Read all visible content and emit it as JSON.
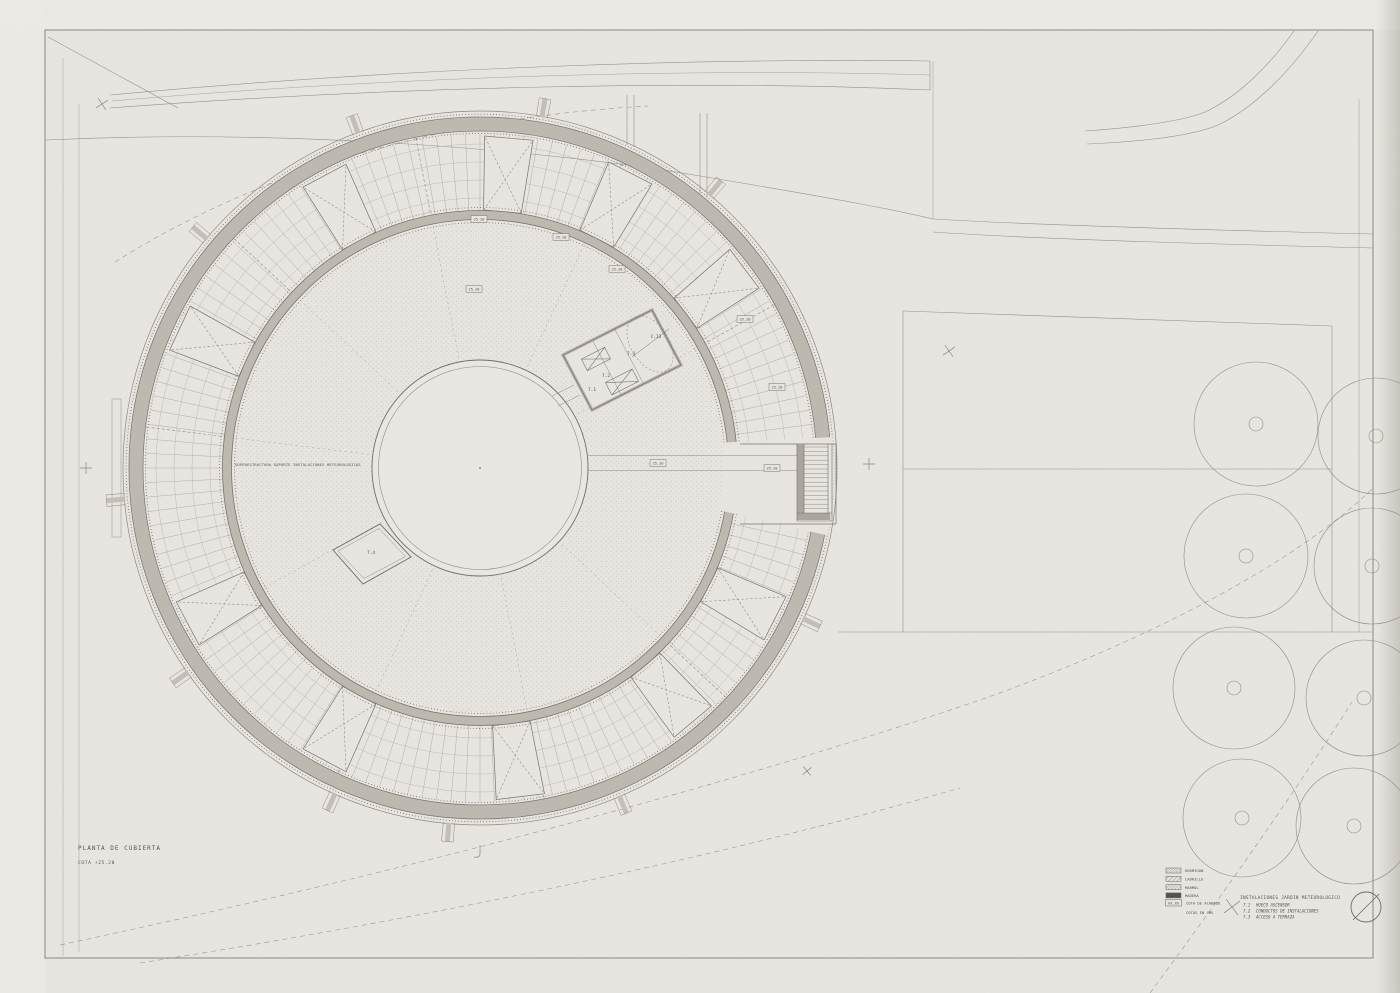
{
  "sheet": {
    "title": "PLANTA DE CUBIERTA",
    "subtitle": "COTA +25.20",
    "center_note": "SUPERESTRUCTURA SOPORTE INSTALACIONES METEOROLOGICAS"
  },
  "legend": {
    "materials": [
      {
        "name": "HORMIGON"
      },
      {
        "name": "LADRILLO"
      },
      {
        "name": "MARMOL"
      },
      {
        "name": "MADERA"
      }
    ],
    "cota_box": "XX.XX",
    "cota_label": "COTA DE ACABADO",
    "units_note": "COTAS EN CMS"
  },
  "keynotes": {
    "title": "INSTALACIONES JARDIN METEOROLOGICO",
    "items": [
      {
        "code": "7.1",
        "label": "HUECO ASCENSOR"
      },
      {
        "code": "7.2",
        "label": "CONDUCTOS DE INSTALACIONES"
      },
      {
        "code": "7.3",
        "label": "ACCESO A TERRAZA"
      }
    ]
  },
  "plan_labels": {
    "elevator": "7.1",
    "conduits": "7.2",
    "hatch": "7.3",
    "skylight": "7.4",
    "detail_ref": "C.13",
    "cota_value": "25.20"
  },
  "colors": {
    "paper": "#e9e6e1",
    "band": "#bdb9b1",
    "line_dark": "#6e6b65",
    "line_mid": "#8a867f",
    "line_light": "#a8a49d"
  }
}
